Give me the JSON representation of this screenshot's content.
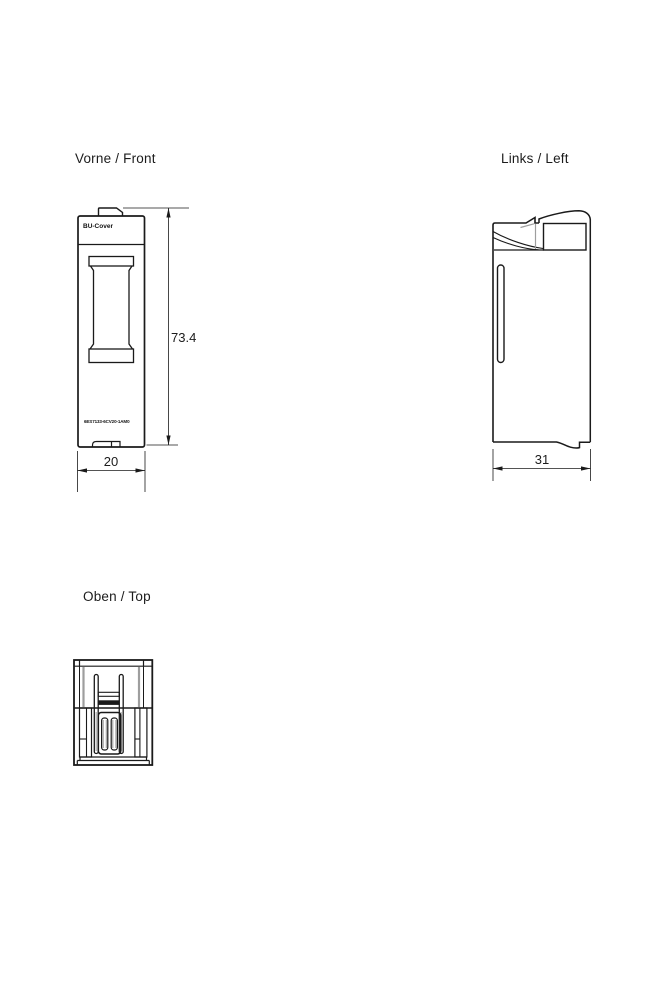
{
  "page": {
    "background": "#ffffff",
    "line_color": "#1a1a1a",
    "accent_gray": "#9e9e9e"
  },
  "views": {
    "front": {
      "label": "Vorne / Front",
      "product_label": "BU-Cover",
      "article_number": "6ES7133-6CV20-1AM0",
      "dimensions": {
        "height_mm": "73.4",
        "width_mm": "20"
      }
    },
    "left": {
      "label": "Links / Left",
      "dimensions": {
        "depth_mm": "31"
      }
    },
    "top": {
      "label": "Oben / Top"
    }
  }
}
